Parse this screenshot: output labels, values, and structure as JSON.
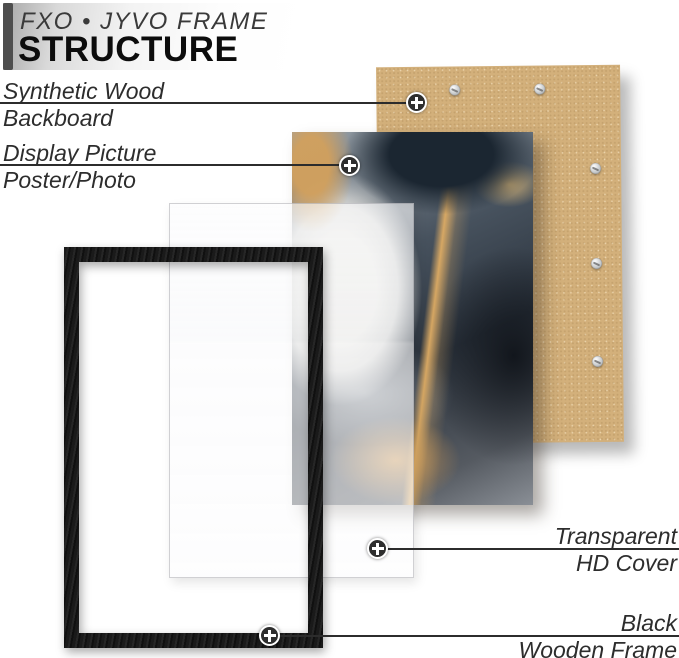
{
  "header": {
    "brand": "FXO • JYVO FRAME",
    "title": "STRUCTURE"
  },
  "callouts": {
    "backboard": {
      "line1": "Synthetic Wood",
      "line2": "Backboard"
    },
    "picture": {
      "line1": "Display Picture",
      "line2": "Poster/Photo"
    },
    "cover": {
      "line1": "Transparent",
      "line2": "HD Cover"
    },
    "frame": {
      "line1": "Black",
      "line2": "Wooden Frame"
    }
  },
  "components": {
    "backboard": "synthetic-wood-backboard",
    "picture": "marble-art-poster",
    "cover": "transparent-hd-cover",
    "frame": "black-wooden-frame",
    "screw_count": 5
  },
  "icons": {
    "marker": "plus-target-icon",
    "screw": "screw-icon"
  },
  "colors": {
    "backboard_tan": "#d3b07b",
    "frame_black": "#1a1a1a",
    "label_text": "#2d2d2d",
    "banner_dark_bar": "#4e4e4e",
    "marble_navy": "#27313d",
    "marble_gold": "#cf9a5c"
  }
}
